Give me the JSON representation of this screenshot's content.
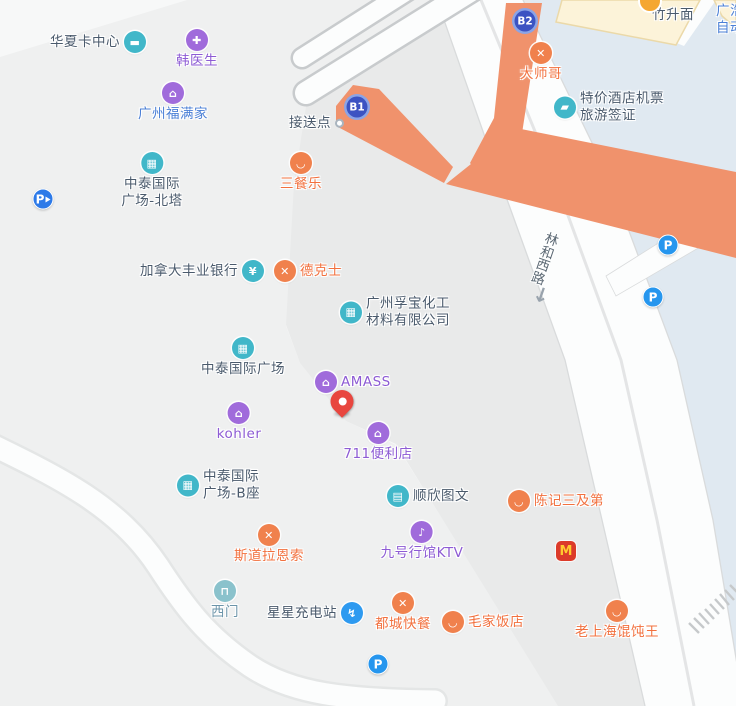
{
  "map": {
    "colors": {
      "mapfill": {
        "base": "#f7f8f8",
        "block_light": "#eff0f0",
        "block_dark": "#e9eaea",
        "water": "#e0e9f1",
        "road": "#fcfdfd",
        "road_edge": "#d9dbdc",
        "divider": "#e4e5e6",
        "route": "#f0926c",
        "bridge_edge": "#c8cbcd",
        "cream": "#fcf3d9",
        "cream_edge": "#ebd9a9",
        "hatch": "#c6c9cb"
      },
      "icon": {
        "teal": "#41b7c9",
        "purple": "#a06bdb",
        "orange": "#f0814d",
        "tealsoft": "#8ac2cc",
        "bluecharge": "#2e9af0"
      },
      "text": {
        "dark": "#4a5a6c",
        "purple": "#8d5bd4",
        "orange": "#f2703e",
        "blue": "#4a7fd6",
        "teal": "#6b94a9"
      },
      "badge_core": "#3c53c2",
      "badge_ring": "#8ba4e6",
      "parking_blue": "#2696ee",
      "parking_entrance_blue": "#2d7ae8",
      "mcd_red": "#dc3b2a",
      "mcd_yellow": "#ffcb2f",
      "pin_red": "#e8463f",
      "noodle_orange": "#f5a731",
      "road_label": "#5d6a75"
    },
    "glyphs": {
      "card": "▬",
      "medical": "✚",
      "bag": "⌂",
      "building": "▦",
      "yen": "¥",
      "utensils": "✕",
      "bowl": "◡",
      "store": "⌂",
      "printer": "▤",
      "mic": "♪",
      "door": "⊓",
      "charge": "↯",
      "ticket": "▰"
    },
    "road": {
      "name": "林和西路",
      "arrow": "↓"
    },
    "pois": [
      {
        "id": "poi-huaxia-card-center",
        "layout": "icon-right",
        "x": 135,
        "y": 42,
        "lines": [
          "华夏卡中心"
        ],
        "icon": "card",
        "icolor": "teal",
        "tcolor": "dark"
      },
      {
        "id": "poi-han-doctor",
        "layout": "icon-top",
        "x": 197,
        "y": 40,
        "lines": [
          "韩医生"
        ],
        "icon": "medical",
        "icolor": "purple",
        "tcolor": "purple"
      },
      {
        "id": "poi-guangzhou-fumanjia",
        "layout": "icon-top",
        "x": 173,
        "y": 93,
        "lines": [
          "广州福满家"
        ],
        "icon": "bag",
        "icolor": "purple",
        "tcolor": "blue"
      },
      {
        "id": "poi-zhongtai-north-tower",
        "layout": "icon-top",
        "x": 152,
        "y": 163,
        "lines": [
          "中泰国际",
          "广场-北塔"
        ],
        "icon": "building",
        "icolor": "teal",
        "tcolor": "dark"
      },
      {
        "id": "poi-sancanle",
        "layout": "icon-top",
        "x": 301,
        "y": 163,
        "lines": [
          "三餐乐"
        ],
        "icon": "bowl",
        "icolor": "orange",
        "tcolor": "orange"
      },
      {
        "id": "poi-jiesongdian",
        "layout": "icon-right",
        "x": 333,
        "y": 123,
        "lines": [
          "接送点"
        ],
        "icon": "dot",
        "tcolor": "dark"
      },
      {
        "id": "poi-scotiabank",
        "layout": "icon-right",
        "x": 253,
        "y": 271,
        "lines": [
          "加拿大丰业银行"
        ],
        "icon": "yen",
        "icolor": "teal",
        "tcolor": "dark"
      },
      {
        "id": "poi-dicos",
        "layout": "icon-left",
        "x": 285,
        "y": 271,
        "lines": [
          "德克士"
        ],
        "icon": "utensils",
        "icolor": "orange",
        "tcolor": "orange"
      },
      {
        "id": "poi-fubao-chemical",
        "layout": "icon-left",
        "x": 351,
        "y": 312,
        "lines": [
          "广州孚宝化工",
          "材料有限公司"
        ],
        "icon": "building",
        "icolor": "teal",
        "tcolor": "dark"
      },
      {
        "id": "poi-zhongtai-plaza",
        "layout": "icon-top",
        "x": 243,
        "y": 348,
        "lines": [
          "中泰国际广场"
        ],
        "icon": "building",
        "icolor": "teal",
        "tcolor": "dark"
      },
      {
        "id": "poi-amass",
        "layout": "icon-left",
        "x": 326,
        "y": 382,
        "lines": [
          "AMASS"
        ],
        "icon": "bag",
        "icolor": "purple",
        "tcolor": "purple"
      },
      {
        "id": "poi-kohler",
        "layout": "icon-top",
        "x": 239,
        "y": 413,
        "lines": [
          "kohler"
        ],
        "icon": "bag",
        "icolor": "purple",
        "tcolor": "purple"
      },
      {
        "id": "poi-711-store",
        "layout": "icon-top",
        "x": 378,
        "y": 433,
        "lines": [
          "711便利店"
        ],
        "icon": "store",
        "icolor": "purple",
        "tcolor": "purple"
      },
      {
        "id": "poi-zhongtai-b",
        "layout": "icon-left",
        "x": 188,
        "y": 485,
        "lines": [
          "中泰国际",
          "广场-B座"
        ],
        "icon": "building",
        "icolor": "teal",
        "tcolor": "dark"
      },
      {
        "id": "poi-shunxin-print",
        "layout": "icon-left",
        "x": 398,
        "y": 496,
        "lines": [
          "顺欣图文"
        ],
        "icon": "printer",
        "icolor": "teal",
        "tcolor": "dark"
      },
      {
        "id": "poi-chenji",
        "layout": "icon-left",
        "x": 519,
        "y": 501,
        "lines": [
          "陈记三及第"
        ],
        "icon": "bowl",
        "icolor": "orange",
        "tcolor": "orange"
      },
      {
        "id": "poi-stora-enso",
        "layout": "icon-top",
        "x": 269,
        "y": 535,
        "lines": [
          "斯道拉恩索"
        ],
        "icon": "utensils",
        "icolor": "orange",
        "tcolor": "orange"
      },
      {
        "id": "poi-jiuhao-ktv",
        "layout": "icon-top",
        "x": 422,
        "y": 532,
        "lines": [
          "九号行馆KTV"
        ],
        "icon": "mic",
        "icolor": "purple",
        "tcolor": "purple"
      },
      {
        "id": "poi-ximen",
        "layout": "icon-top",
        "x": 225,
        "y": 591,
        "lines": [
          "西门"
        ],
        "icon": "door",
        "icolor": "tealsoft",
        "tcolor": "teal"
      },
      {
        "id": "poi-xingxing-charging",
        "layout": "icon-right",
        "x": 352,
        "y": 613,
        "lines": [
          "星星充电站"
        ],
        "icon": "charge",
        "icolor": "bluecharge",
        "tcolor": "dark"
      },
      {
        "id": "poi-ducheng",
        "layout": "icon-top",
        "x": 403,
        "y": 603,
        "lines": [
          "都城快餐"
        ],
        "icon": "utensils",
        "icolor": "orange",
        "tcolor": "orange"
      },
      {
        "id": "poi-maojia",
        "layout": "icon-left",
        "x": 453,
        "y": 622,
        "lines": [
          "毛家饭店"
        ],
        "icon": "bowl",
        "icolor": "orange",
        "tcolor": "orange"
      },
      {
        "id": "poi-laoshanghai",
        "layout": "icon-top",
        "x": 617,
        "y": 611,
        "lines": [
          "老上海馄饨王"
        ],
        "icon": "bowl",
        "icolor": "orange",
        "tcolor": "orange"
      },
      {
        "id": "poi-dashige",
        "layout": "icon-top",
        "x": 541,
        "y": 53,
        "lines": [
          "大师哥"
        ],
        "icon": "utensils",
        "icolor": "orange",
        "tcolor": "orange"
      },
      {
        "id": "poi-tejia-hotel-ticket",
        "layout": "icon-left",
        "x": 565,
        "y": 107,
        "lines": [
          "特价酒店机票",
          "旅游签证"
        ],
        "icon": "ticket",
        "icolor": "teal",
        "tcolor": "dark"
      },
      {
        "id": "poi-zhushengmian",
        "layout": "text",
        "x": 673,
        "y": 15,
        "lines": [
          "竹升面"
        ],
        "tcolor": "dark"
      },
      {
        "id": "poi-guanghao",
        "layout": "corner",
        "x": 716,
        "y": 3,
        "lines": [
          "广浩",
          "自动"
        ],
        "tcolor": "blue"
      }
    ],
    "markers": [
      {
        "id": "subway-exit-b1",
        "kind": "badge",
        "x": 357,
        "y": 107,
        "text": "B1"
      },
      {
        "id": "subway-exit-b2",
        "kind": "badge",
        "x": 525,
        "y": 21,
        "text": "B2"
      },
      {
        "id": "parking-entrance",
        "kind": "parking",
        "x": 43,
        "y": 199,
        "entrance": true,
        "text": "P"
      },
      {
        "id": "parking-northeast",
        "kind": "parking",
        "x": 668,
        "y": 245,
        "text": "P"
      },
      {
        "id": "parking-east",
        "kind": "parking",
        "x": 653,
        "y": 297,
        "text": "P"
      },
      {
        "id": "parking-south",
        "kind": "parking",
        "x": 378,
        "y": 664,
        "text": "P"
      },
      {
        "id": "mcdonalds",
        "kind": "mcd",
        "x": 566,
        "y": 551,
        "text": "M"
      },
      {
        "id": "zhushengmian-icon",
        "kind": "circle",
        "x": 650,
        "y": 1
      },
      {
        "id": "location-pin",
        "kind": "pin",
        "x": 342,
        "y": 413
      }
    ]
  }
}
